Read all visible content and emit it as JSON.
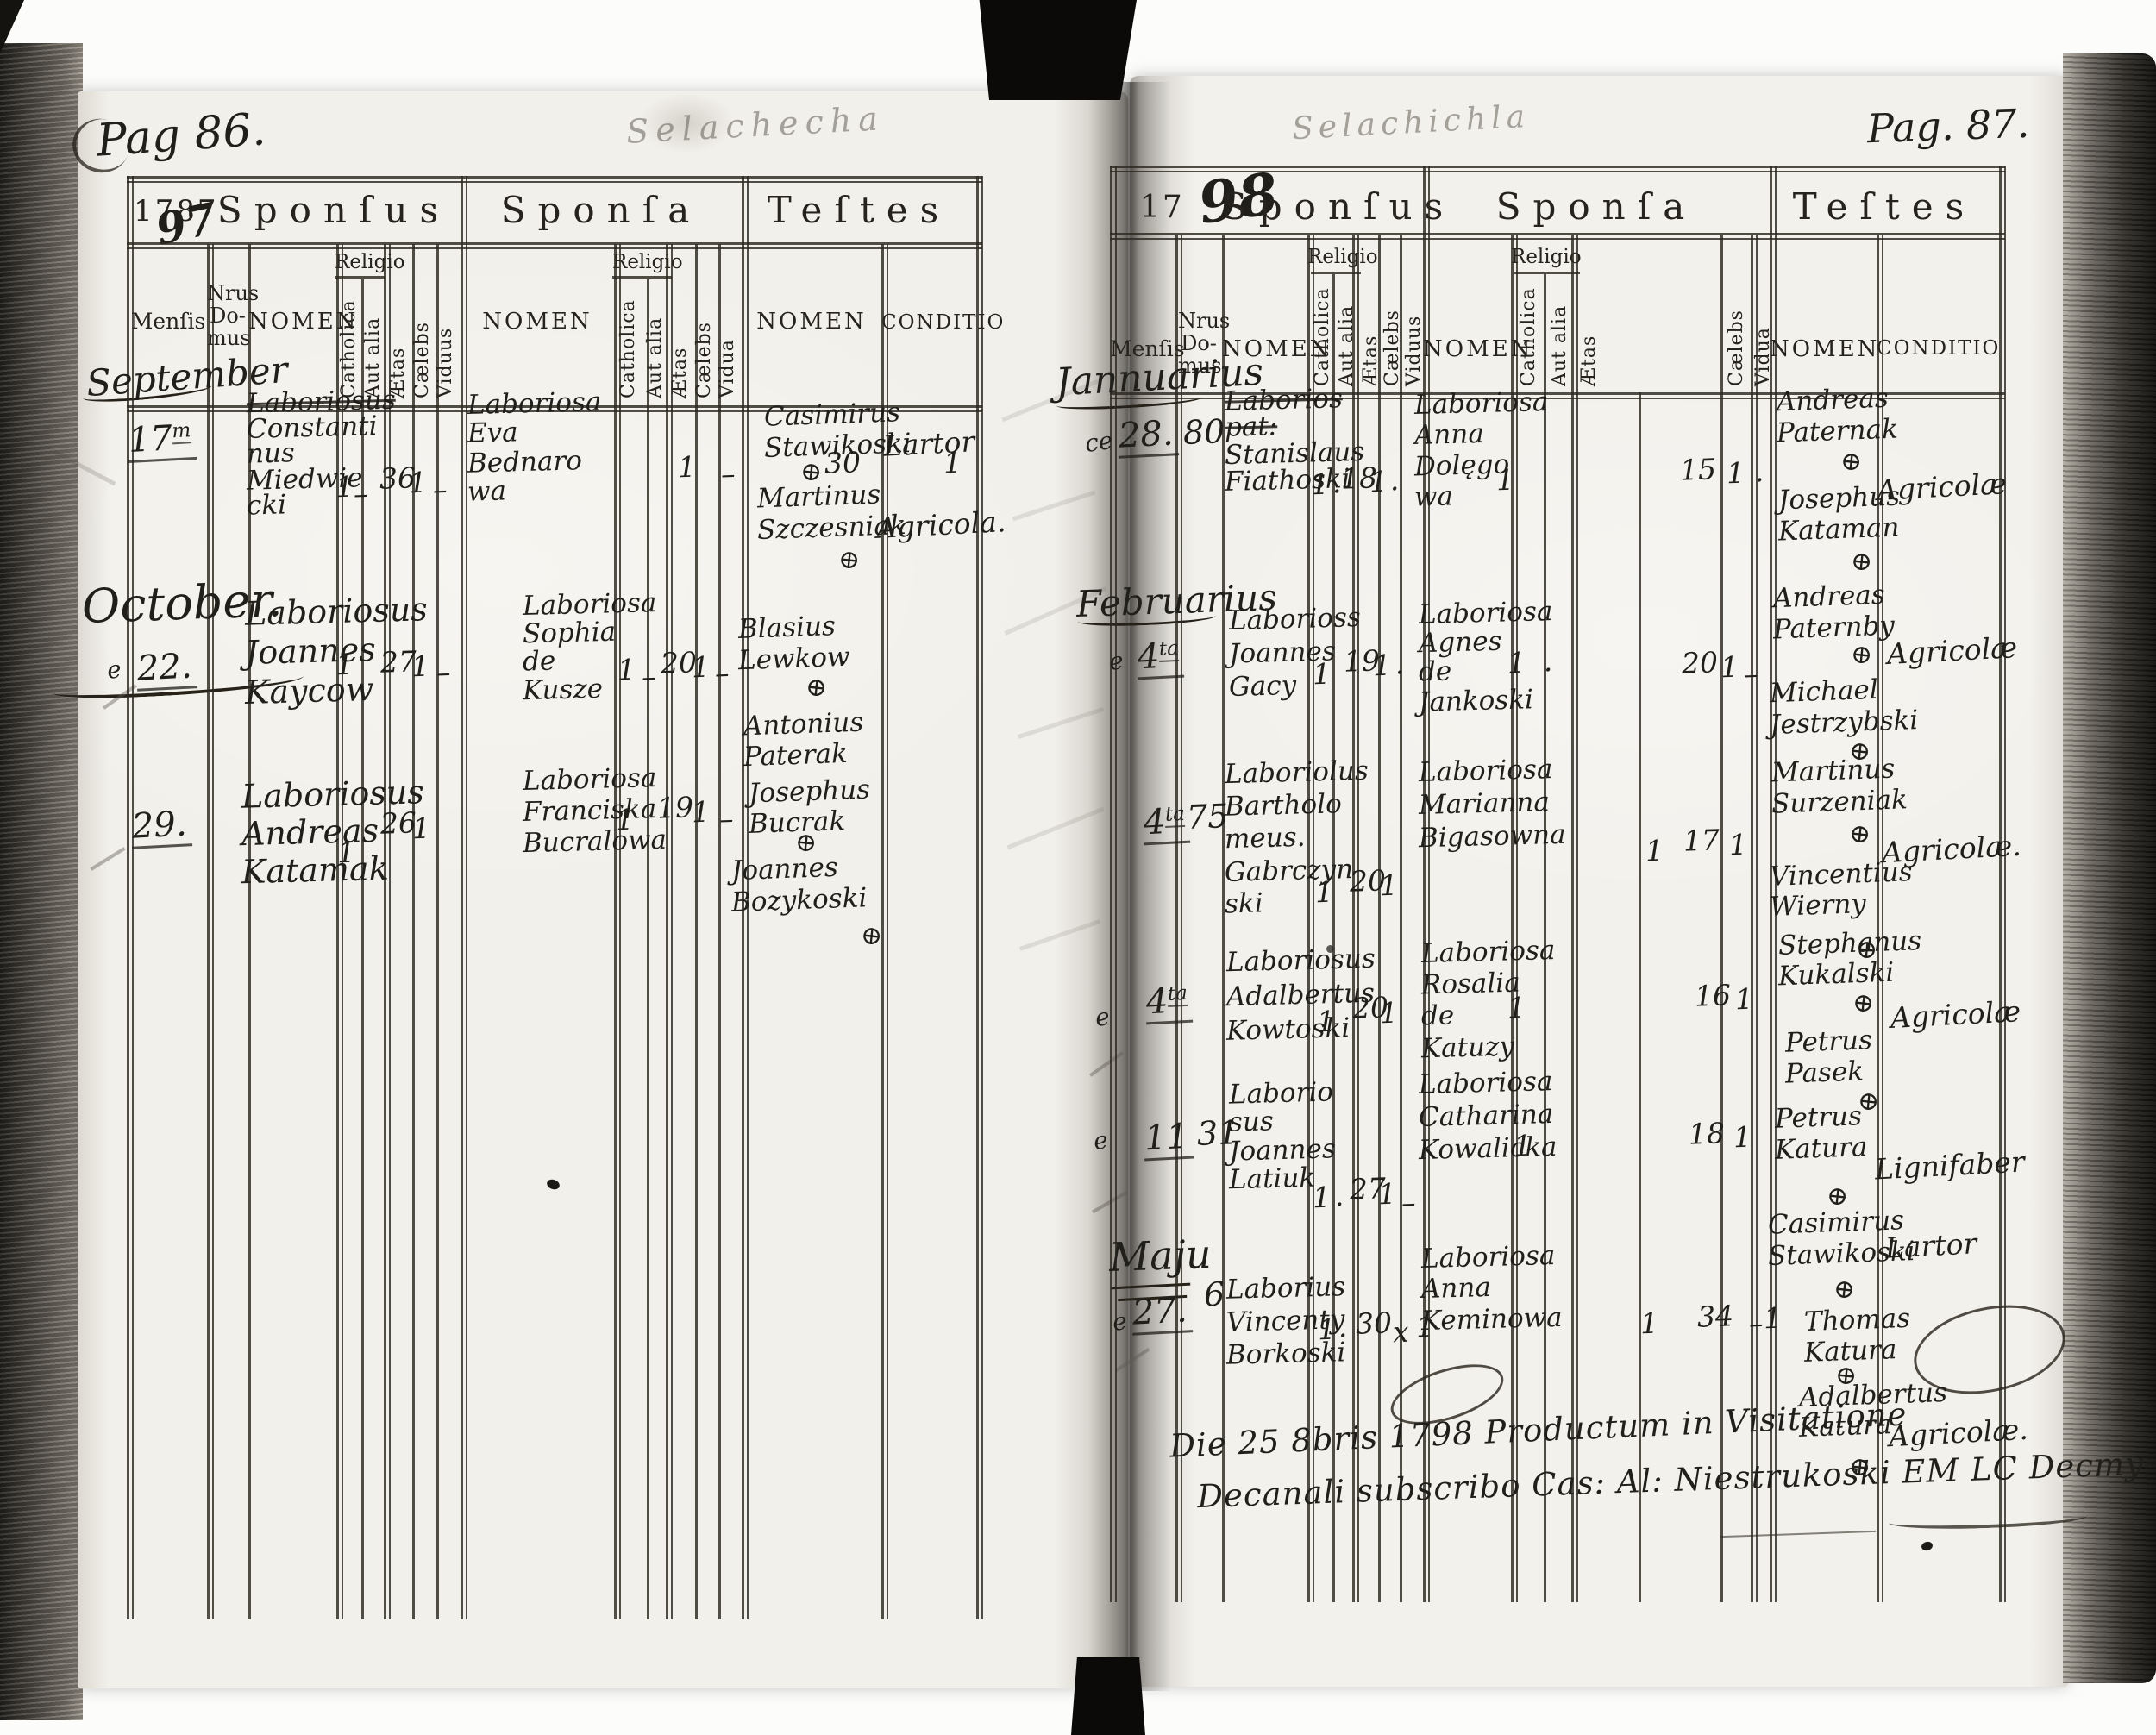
{
  "document": {
    "headers": {
      "sponsus": "Sponſus",
      "sponsa": "Sponſa",
      "testes": "Teſtes",
      "mensis": "Menſis",
      "nrus_domus": [
        "Nrus",
        "Do-",
        "mus"
      ],
      "nomen": "NOMEN",
      "religio": "Religio",
      "catholica": "Catholica",
      "aut_alia": "Aut alia",
      "aetas": "Ætas",
      "caelebs": "Cælebs",
      "viduus": "Viduus",
      "vidua": "Vidua",
      "conditio": "CONDITIO"
    },
    "left_page": {
      "page_label": "Pag 86.",
      "year_printed": "1787",
      "year_handwritten": "97",
      "pencil_header": "Selachecha",
      "months": [
        "September",
        "October."
      ],
      "entries": [
        {
          "day": "17",
          "day_sup": "m",
          "sponsus": [
            {
              "t": "Laboriosus",
              "struck": true
            },
            "Constanti",
            "nus",
            "Miedwie",
            "cki"
          ],
          "sponsus_vals": {
            "catholica": "1",
            "aut_alia": "–",
            "aetas": "36",
            "caelebs": "1",
            "viduus": "–"
          },
          "sponsa": [
            "Laboriosa",
            "Eva",
            "Bednaro",
            "wa"
          ],
          "sponsa_vals": {
            "catholica": "1",
            "aut_alia": "–",
            "aetas": "30",
            "caelebs": "1"
          },
          "witnesses": [
            {
              "name": [
                "Casimirus",
                "Stawikoski"
              ],
              "cross": true
            },
            {
              "name": [
                "Martinus",
                "Szczesniak"
              ],
              "cross": true
            }
          ],
          "conditio": [
            "Lartor",
            "Agricola."
          ]
        },
        {
          "prefix": "e",
          "day": "22.",
          "sponsus": [
            "Laboriosus",
            "Joannes",
            "Kaycow"
          ],
          "sponsus_vals": {
            "catholica": "1",
            "aetas": "27",
            "caelebs": "1",
            "viduus": "–"
          },
          "sponsa": [
            "Laboriosa",
            "Sophia",
            "de",
            "Kusze"
          ],
          "sponsa_vals": {
            "catholica": "1",
            "aut_alia": "–",
            "aetas": "20",
            "caelebs": "1",
            "vidua": "–"
          },
          "witnesses": [
            {
              "name": [
                "Blasius",
                "Lewkow"
              ],
              "cross": true
            },
            {
              "name": [
                "Antonius",
                "Paterak"
              ],
              "cross": false
            }
          ],
          "conditio": []
        },
        {
          "day": "29.",
          "sponsus": [
            "Laboriosus",
            "Andreas",
            "Katamak"
          ],
          "sponsus_vals": {
            "catholica": "1",
            "aetas": "26",
            "caelebs": "1"
          },
          "sponsa": [
            "Laboriosa",
            "Franciska",
            "Bucralowa"
          ],
          "sponsa_vals": {
            "catholica": "1",
            "aetas": "19",
            "caelebs": "1",
            "vidua": "–"
          },
          "witnesses": [
            {
              "name": [
                "Josephus",
                "Bucrak"
              ],
              "cross": true
            },
            {
              "name": [
                "Joannes",
                "Bozykoski"
              ],
              "cross": true
            }
          ],
          "conditio": []
        }
      ]
    },
    "right_page": {
      "page_label": "Pag. 87.",
      "year_printed": "17",
      "year_handwritten": "98",
      "pencil_header": "Selachichla",
      "months": [
        "Jannuarius",
        "Februarius",
        "Maju"
      ],
      "entries": [
        {
          "prefix": "ce",
          "day": "28.",
          "nrus": "80",
          "sponsus": [
            {
              "t": "Laborios",
              "struck": true
            },
            {
              "t": "pat:",
              "struck": true
            },
            "Stanislaus",
            "Fiathoski"
          ],
          "sponsus_vals": {
            "catholica": "1",
            "aut_alia": "·",
            "aetas": "18",
            "caelebs": "1",
            "viduus": "·"
          },
          "sponsa": [
            "Laboriosa",
            "Anna",
            "Dolęgo",
            "wa"
          ],
          "sponsa_vals": {
            "catholica": "1",
            "aetas": "15",
            "caelebs": "1",
            "vidua": "·"
          },
          "witnesses": [
            {
              "name": [
                "Andreas",
                "Paternak"
              ],
              "cross": true
            },
            {
              "name": [
                "Josephus",
                "Kataman"
              ],
              "cross": true
            }
          ],
          "conditio": [
            "Agricolæ"
          ]
        },
        {
          "prefix": "e",
          "day": "4",
          "day_sup": "ta",
          "sponsus": [
            "Laborioss",
            "Joannes",
            "Gacy"
          ],
          "sponsus_vals": {
            "catholica": "1",
            "aetas": "19",
            "caelebs": "1",
            "viduus": "·"
          },
          "sponsa": [
            "Laboriosa",
            "Agnes",
            "de",
            "Jankoski"
          ],
          "sponsa_vals": {
            "catholica": "1",
            "aut_alia": "·",
            "aetas": "20",
            "caelebs": "1",
            "vidua": "–"
          },
          "witnesses": [
            {
              "name": [
                "Andreas",
                "Paternby"
              ],
              "cross": true
            },
            {
              "name": [
                "Michael",
                "Jestrzybski"
              ],
              "cross": true
            }
          ],
          "conditio": [
            "Agricolæ"
          ]
        },
        {
          "day": "4",
          "day_sup": "ta",
          "nrus": "75",
          "sponsus": [
            "Laboriolus",
            "Bartholo",
            "meus.",
            "Gabrczyn",
            "ski"
          ],
          "sponsus_vals": {
            "catholica": "1",
            "aetas": "20",
            "caelebs": "1"
          },
          "sponsa": [
            "Laboriosa",
            "Marianna",
            "Bigasowna"
          ],
          "sponsa_vals": {
            "catholica": "1",
            "aetas": "17",
            "caelebs": "1"
          },
          "witnesses": [
            {
              "name": [
                "Martinus",
                "Surzeniak"
              ],
              "cross": true
            },
            {
              "name": [
                "Vincentius",
                "Wierny"
              ],
              "cross": true
            }
          ],
          "conditio": [
            "Agricolæ."
          ]
        },
        {
          "prefix": "e",
          "day": "4",
          "day_sup": "ta",
          "sponsus": [
            "Laboriosus",
            "Adalbertus",
            "Kowtoski"
          ],
          "sponsus_vals": {
            "catholica": "1",
            "aetas": "20",
            "caelebs": "1"
          },
          "sponsa": [
            "Laboriosa",
            "Rosalia",
            "de",
            "Katuzy"
          ],
          "sponsa_vals": {
            "catholica": "1",
            "aetas": "16",
            "caelebs": "1"
          },
          "witnesses": [
            {
              "name": [
                "Stephanus",
                "Kukalski"
              ],
              "cross": true
            },
            {
              "name": [
                "Petrus",
                "Pasek"
              ],
              "cross": true
            }
          ],
          "conditio": [
            "Agricolæ"
          ]
        },
        {
          "prefix": "e",
          "day": "11",
          "nrus": "31",
          "sponsus": [
            "Laborio",
            "sus",
            "Joannes",
            "Latiuk"
          ],
          "sponsus_vals": {
            "catholica": "1",
            "aut_alia": "·",
            "aetas": "27",
            "caelebs": "1",
            "viduus": "–"
          },
          "sponsa": [
            "Laboriosa",
            "Catharina",
            "Kowalicka"
          ],
          "sponsa_vals": {
            "catholica": "1",
            "aetas": "18",
            "caelebs": "1"
          },
          "witnesses": [
            {
              "name": [
                "Petrus",
                "Katura"
              ],
              "cross": true
            },
            {
              "name": [
                "Casimirus",
                "Stawikoski"
              ],
              "cross": true
            }
          ],
          "conditio": [
            "Lignifaber",
            "Lartor"
          ]
        },
        {
          "prefix": "e",
          "day": "27.",
          "nrus": "6",
          "sponsus": [
            "Laborius",
            "Vincenty",
            "Borkoski"
          ],
          "sponsus_vals": {
            "catholica": "1",
            "aut_alia": "·",
            "aetas": "30",
            "caelebs": "x",
            "viduus": "1"
          },
          "sponsa": [
            "Laboriosa",
            "Anna",
            "Keminowa"
          ],
          "sponsa_vals": {
            "catholica": "1",
            "aetas": "34",
            "caelebs": "–",
            "vidua": "1"
          },
          "witnesses": [
            {
              "name": [
                "Thomas",
                "Katura"
              ],
              "cross": true
            },
            {
              "name": [
                "Adalbertus",
                "Katura"
              ],
              "cross": true
            }
          ],
          "conditio": [
            "Agricolæ."
          ]
        }
      ],
      "visitation_note": [
        "Die 25 8bris 1798 Productum in Visitatione",
        "Decanali subscribo Cas: Al: Niestrukoski EM LC Decmy"
      ]
    }
  }
}
